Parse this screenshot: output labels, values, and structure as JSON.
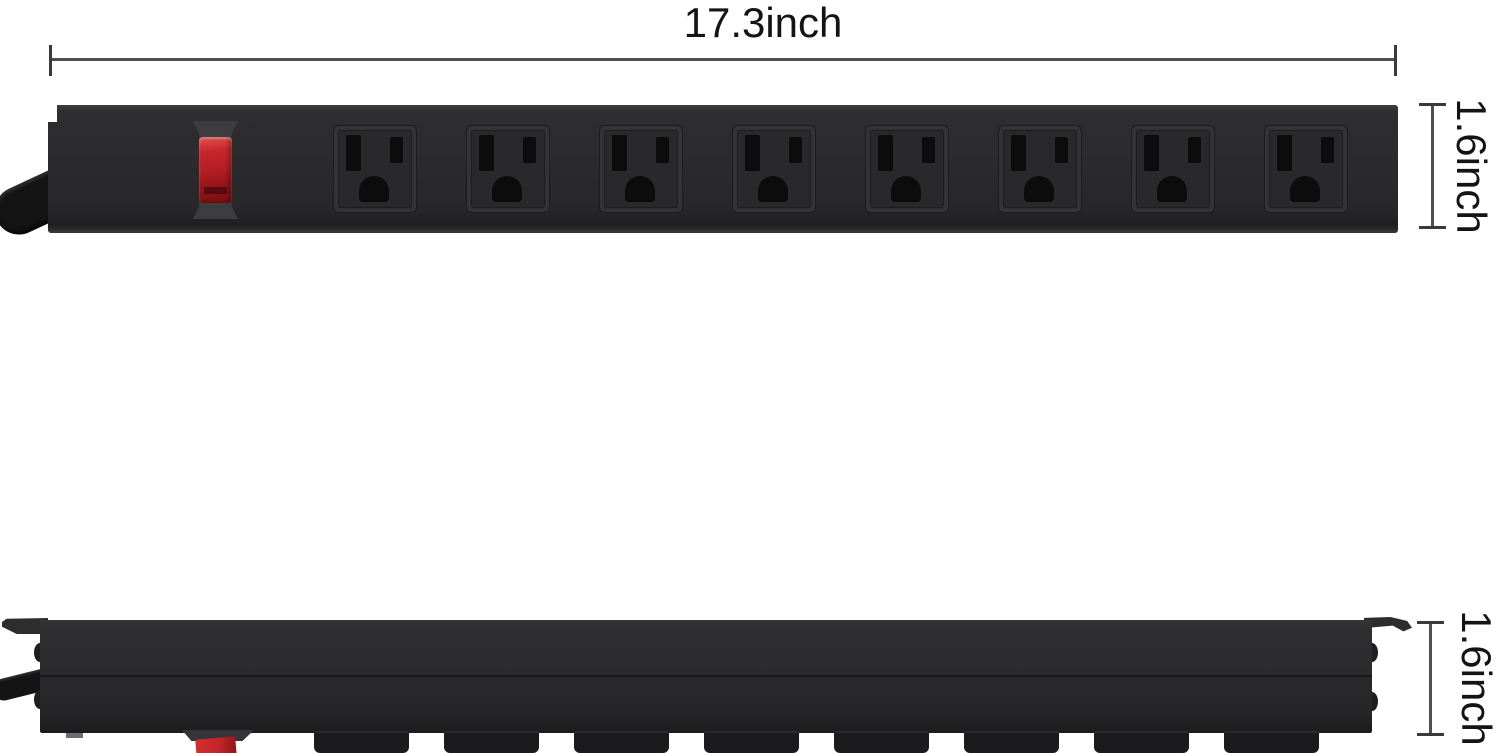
{
  "image": {
    "description": "Black mountable power strip with 8 outlets and red power switch, shown in top view and side view with dimension callouts",
    "background_color": "#ffffff"
  },
  "dimensions": {
    "length": {
      "label": "17.3inch"
    },
    "height_top_view": {
      "label": "1.6inch"
    },
    "height_side_view": {
      "label": "1.6inch"
    },
    "line_color": "#4f4f51",
    "text_color": "#141414"
  },
  "product": {
    "name": "8-outlet power strip",
    "outlet_count": 8,
    "mount_tab_count": 8,
    "body_color": "#2b2b2d",
    "outlet_slot_color": "#0c0c0d",
    "switch_color": "#c8262c",
    "switch_surround_color": "#3d3d40",
    "cord_color": "#141414"
  }
}
